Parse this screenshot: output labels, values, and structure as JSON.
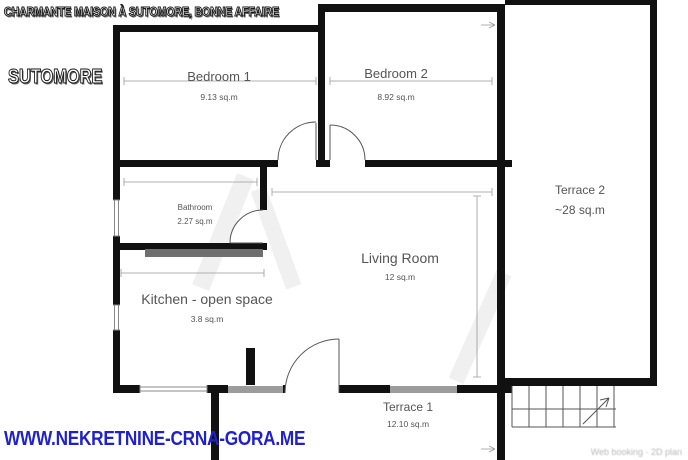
{
  "header": {
    "title": "CHARMANTE MAISON À SUTOMORE, BONNE AFFAIRE",
    "location_label": "SUTOMORE"
  },
  "footer": {
    "website": "WWW.NEKRETNINE-CRNA-GORA.ME",
    "fineprint": "Web booking · 2D plan"
  },
  "rooms": [
    {
      "name": "Bedroom 1",
      "area": "9.13 sq.m"
    },
    {
      "name": "Bedroom 2",
      "area": "8.92 sq.m"
    },
    {
      "name": "Bathroom",
      "area": "2.27 sq.m"
    },
    {
      "name": "Living Room",
      "area": "12 sq.m"
    },
    {
      "name": "Kitchen - open space",
      "area": "3.8 sq.m"
    },
    {
      "name": "Terrace 2",
      "area": "~28 sq.m"
    },
    {
      "name": "Terrace 1",
      "area": "12.10 sq.m"
    }
  ],
  "colors": {
    "wall": "#111111",
    "window_gray": "#9c9c9c",
    "url_blue": "#2121cb",
    "label_gray": "#555555"
  }
}
